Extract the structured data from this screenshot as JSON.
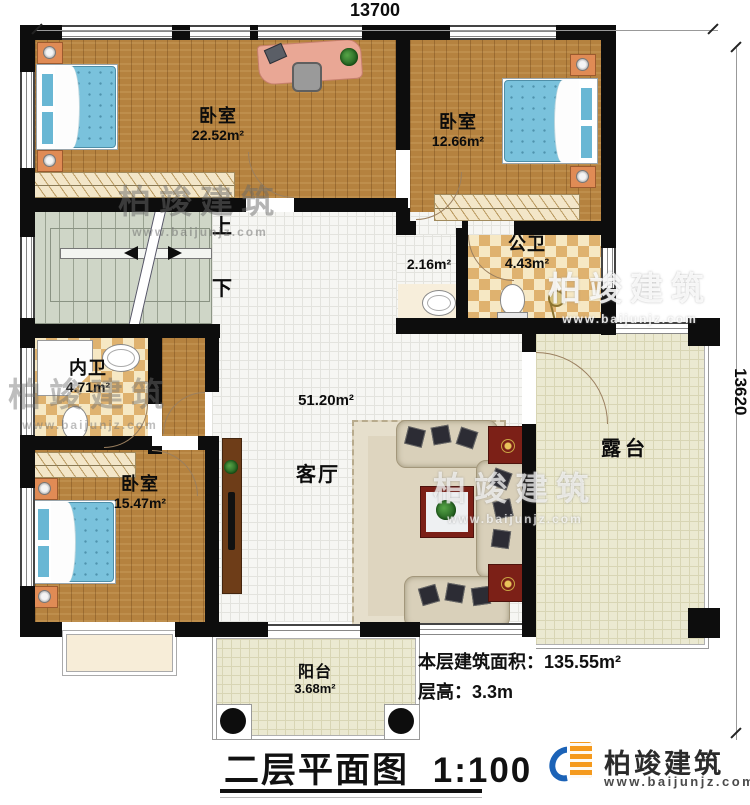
{
  "dimensions": {
    "top": "13700",
    "right": "13620"
  },
  "rooms": {
    "bedroom_top_left": {
      "name": "卧室",
      "area": "22.52m²"
    },
    "bedroom_top_right": {
      "name": "卧室",
      "area": "12.66m²"
    },
    "bedroom_bottom_left": {
      "name": "卧室",
      "area": "15.47m²"
    },
    "living_room": {
      "name": "客厅",
      "area": "51.20m²"
    },
    "public_bathroom": {
      "name": "公卫",
      "area": "4.43m²"
    },
    "private_bathroom": {
      "name": "内卫",
      "area": "4.71m²"
    },
    "hallway": {
      "area": "2.16m²"
    },
    "terrace": {
      "name": "露台"
    },
    "balcony": {
      "name": "阳台",
      "area": "3.68m²"
    }
  },
  "stairs": {
    "up": "上",
    "down": "下"
  },
  "title": {
    "text": "二层平面图",
    "scale": "1:100"
  },
  "info": {
    "area_label": "本层建筑面积：",
    "area_value": "135.55m²",
    "height_label": "层高：",
    "height_value": "3.3m"
  },
  "brand": {
    "name": "柏竣建筑",
    "url": "www.baijunjz.com"
  },
  "watermark": {
    "line1": "柏竣建筑",
    "line2": "www.baijunjz.com"
  },
  "colors": {
    "wall": "#0d0d0d",
    "wood": "#b5823f",
    "tile_beige": "#ebe9d1",
    "checker": "#dfb26f",
    "stairs": "#cfd6c7",
    "bed": "#7ac2dc",
    "nightstand": "#e08b55",
    "table_red": "#7c2017",
    "brand_blue": "#1c63b7",
    "brand_orange": "#f59a1d"
  }
}
